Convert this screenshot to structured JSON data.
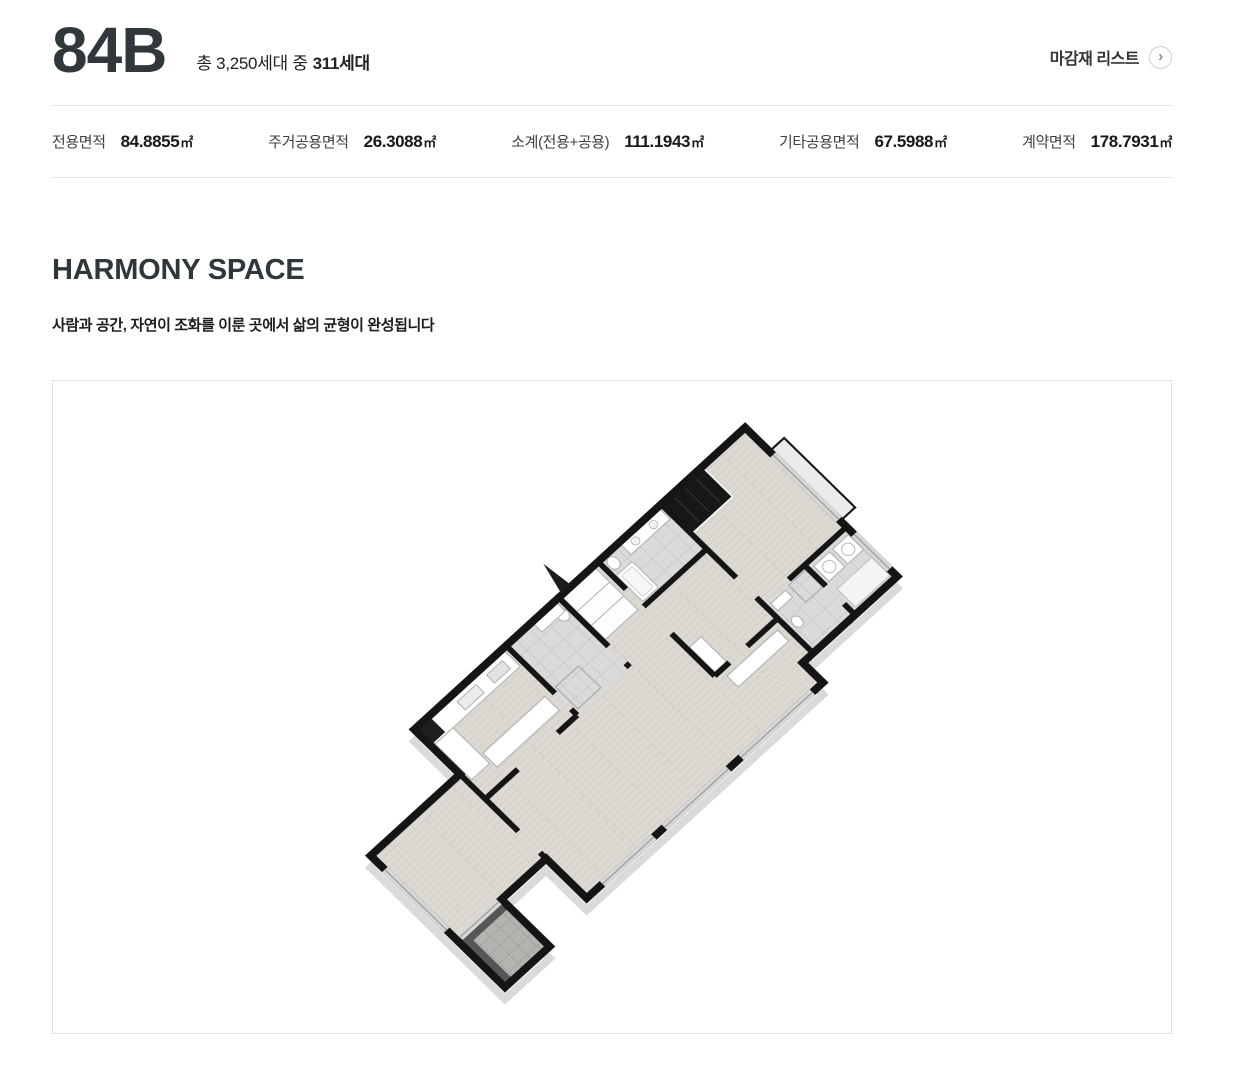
{
  "header": {
    "unit_code": "84B",
    "household_text": "총 3,250세대 중",
    "household_strong": "311세대",
    "finish_list_label": "마감재 리스트",
    "chevron": "›"
  },
  "specs": [
    {
      "label": "전용면적",
      "value": "84.8855",
      "unit": "㎡"
    },
    {
      "label": "주거공용면적",
      "value": "26.3088",
      "unit": "㎡"
    },
    {
      "label": "소계(전용+공용)",
      "value": "111.1943",
      "unit": "㎡"
    },
    {
      "label": "기타공용면적",
      "value": "67.5988",
      "unit": "㎡"
    },
    {
      "label": "계약면적",
      "value": "178.7931",
      "unit": "㎡"
    }
  ],
  "section": {
    "title": "HARMONY SPACE",
    "subtitle": "사람과 공간, 자연이 조화를 이룬 곳에서 삶의 균형이 완성됩니다"
  },
  "floorplan": {
    "colors": {
      "wall": "#151515",
      "wall_shadow": "#dadada",
      "wood_floor": "#dcd9d3",
      "tile_floor": "#dadada",
      "balcony_tile": "#b5b3b0",
      "glass": "#d7d7d7"
    }
  }
}
